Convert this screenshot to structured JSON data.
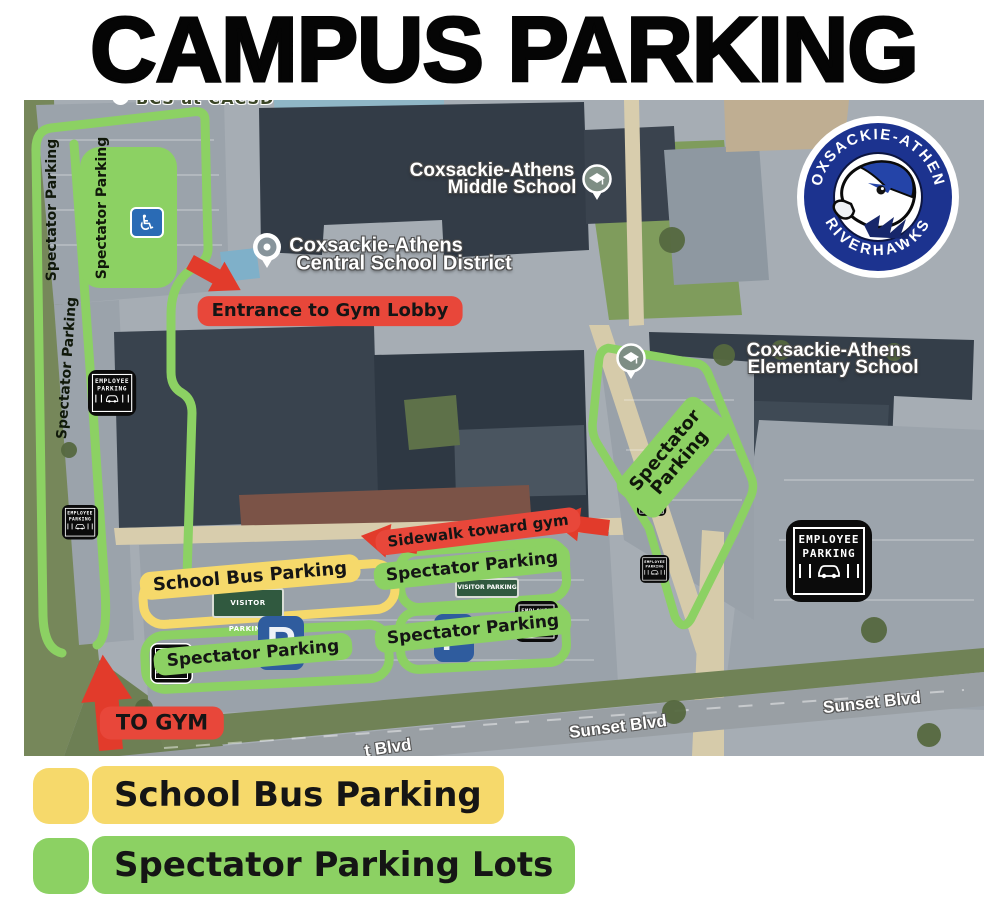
{
  "title": "CAMPUS PARKING",
  "map": {
    "clipped_label": "BCS at CACSD",
    "places": {
      "middle_line1": "Coxsackie-Athens",
      "middle_line2": "Middle School",
      "district_line1": "Coxsackie-Athens",
      "district_line2": "Central School District",
      "elementary_line1": "Coxsackie-Athens",
      "elementary_line2": "Elementary School"
    },
    "roads": {
      "sunset_1": "Sunset Blvd",
      "sunset_2": "Sunset Blvd",
      "sunset_clipped": "t Blvd"
    },
    "annotations": {
      "entrance": "Entrance to Gym Lobby",
      "sidewalk": "Sidewalk toward gym",
      "to_gym": "TO GYM",
      "school_bus": "School Bus Parking",
      "spectator": "Spectator Parking",
      "spectator_line1": "Spectator",
      "spectator_line2": "Parking"
    },
    "signs": {
      "employee_line1": "EMPLOYEE",
      "employee_line2": "PARKING",
      "visitor": "VISITOR PARKING",
      "parking_marking": "P",
      "handicap_icon": "♿"
    },
    "logo": {
      "arc_top": "COXSACKIE-ATHENS",
      "arc_bottom": "RIVERHAWKS"
    }
  },
  "legend": {
    "items": [
      {
        "label": "School Bus Parking",
        "color": "#F6D96B"
      },
      {
        "label": "Spectator Parking Lots",
        "color": "#8CD163"
      }
    ]
  },
  "colors": {
    "spectator_green": "#8CD163",
    "bus_yellow": "#F6D96B",
    "route_red": "#E8473A",
    "logo_blue": "#1C338F"
  }
}
